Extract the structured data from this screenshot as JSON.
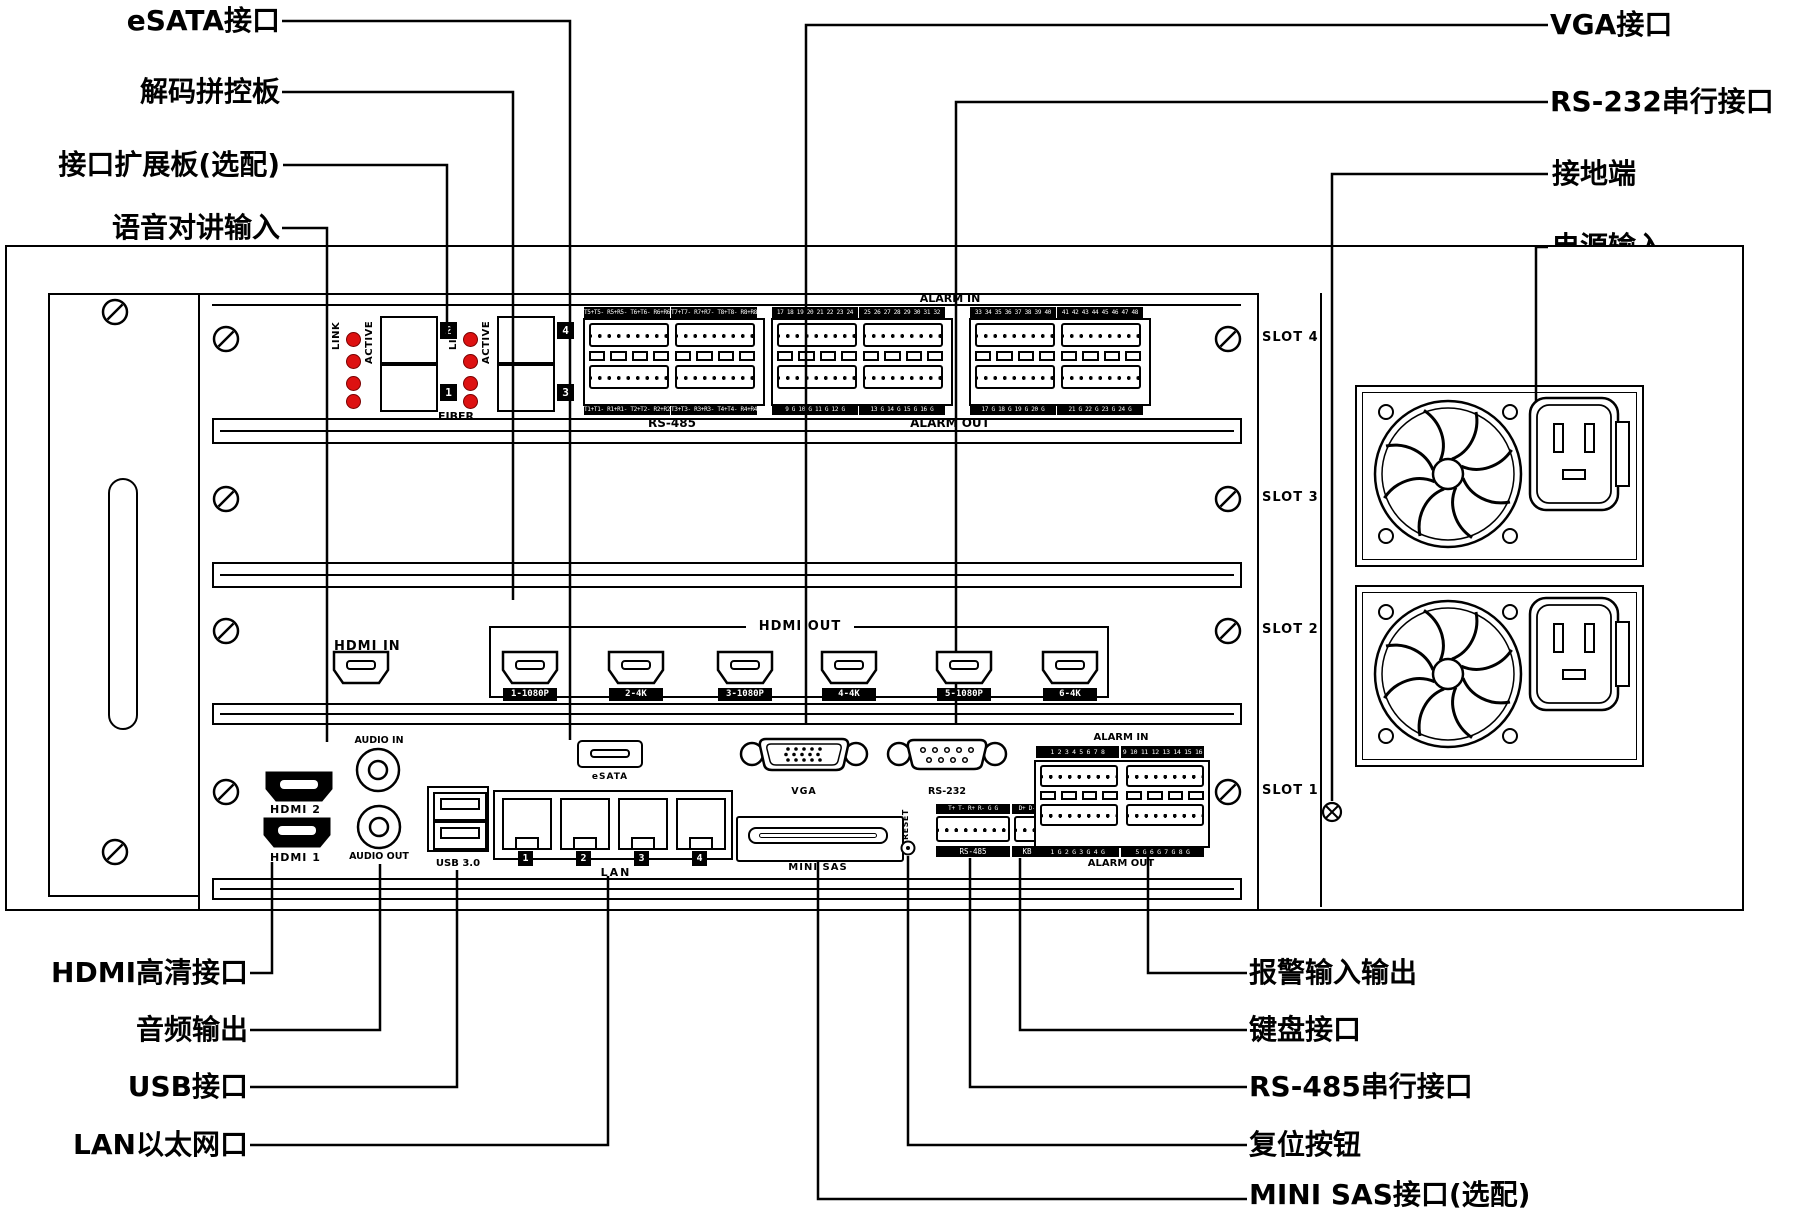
{
  "callouts": {
    "tl": [
      "eSATA接口",
      "解码拼控板",
      "接口扩展板(选配)",
      "语音对讲输入"
    ],
    "tr": [
      "VGA接口",
      "RS-232串行接口",
      "接地端",
      "电源输入"
    ],
    "bl": [
      "HDMI高清接口",
      "音频输出",
      "USB接口",
      "LAN以太网口"
    ],
    "br": [
      "报警输入输出",
      "键盘接口",
      "RS-485串行接口",
      "复位按钮",
      "MINI SAS接口(选配)"
    ]
  },
  "slots": [
    "SLOT 4",
    "SLOT 3",
    "SLOT 2",
    "SLOT 1"
  ],
  "fiber_board": {
    "link": "LINK",
    "active": "ACTIVE",
    "fiber_label": "FIBER",
    "badges": [
      "2",
      "1",
      "4",
      "3"
    ]
  },
  "rs485_board": {
    "headers": [
      "T5+T5- R5+R5- T6+T6- R6+R6-",
      "T7+T7- R7+R7- T8+T8- R8+R8-"
    ],
    "footers": [
      "T1+T1- R1+R1- T2+T2- R2+R2-",
      "T3+T3- R3+R3- T4+T4- R4+R4-"
    ],
    "label": "RS-485"
  },
  "alarm_board": {
    "title": "ALARM IN",
    "headers": [
      "17 18 19 20 21 22 23 24",
      "25 26 27 28 29 30 31 32",
      "33 34 35 36 37 38 39 40",
      "41 42 43 44 45 46 47 48"
    ],
    "footers": [
      "9 G 10 G 11 G 12 G",
      "13 G 14 G 15 G 16 G",
      "17 G 18 G 19 G 20 G",
      "21 G 22 G 23 G 24 G"
    ],
    "out_label": "ALARM OUT"
  },
  "hdmi_board": {
    "in_label": "HDMI IN",
    "out_label": "HDMI OUT",
    "ports": [
      "1-1080P",
      "2-4K",
      "3-1080P",
      "4-4K",
      "5-1080P",
      "6-4K"
    ]
  },
  "io": {
    "audio_in": "AUDIO IN",
    "audio_out": "AUDIO OUT",
    "hdmi2": "HDMI 2",
    "hdmi1": "HDMI 1",
    "esata": "eSATA",
    "usb": "USB 3.0",
    "lan": "LAN",
    "lan_badges": [
      "1",
      "2",
      "3",
      "4"
    ],
    "vga": "VGA",
    "rs232": "RS-232",
    "mini_sas": "MINI SAS",
    "reset": "RESET",
    "serial": {
      "headers": [
        "T+ T- R+ R- G G",
        "D+ D-"
      ],
      "footers": [
        "RS-485",
        "KB"
      ]
    },
    "alarm": {
      "title": "ALARM IN",
      "headers": [
        "1 2 3 4 5 6 7 8",
        "9 10 11 12 13 14 15 16"
      ],
      "footers": [
        "1 G 2 G 3 G 4 G",
        "5 G 6 G 7 G 8 G"
      ],
      "out_label": "ALARM OUT"
    }
  },
  "colors": {
    "line": "#000000",
    "led_red": "#dd1111",
    "bar_bg": "#000000",
    "bar_text": "#ffffff"
  }
}
